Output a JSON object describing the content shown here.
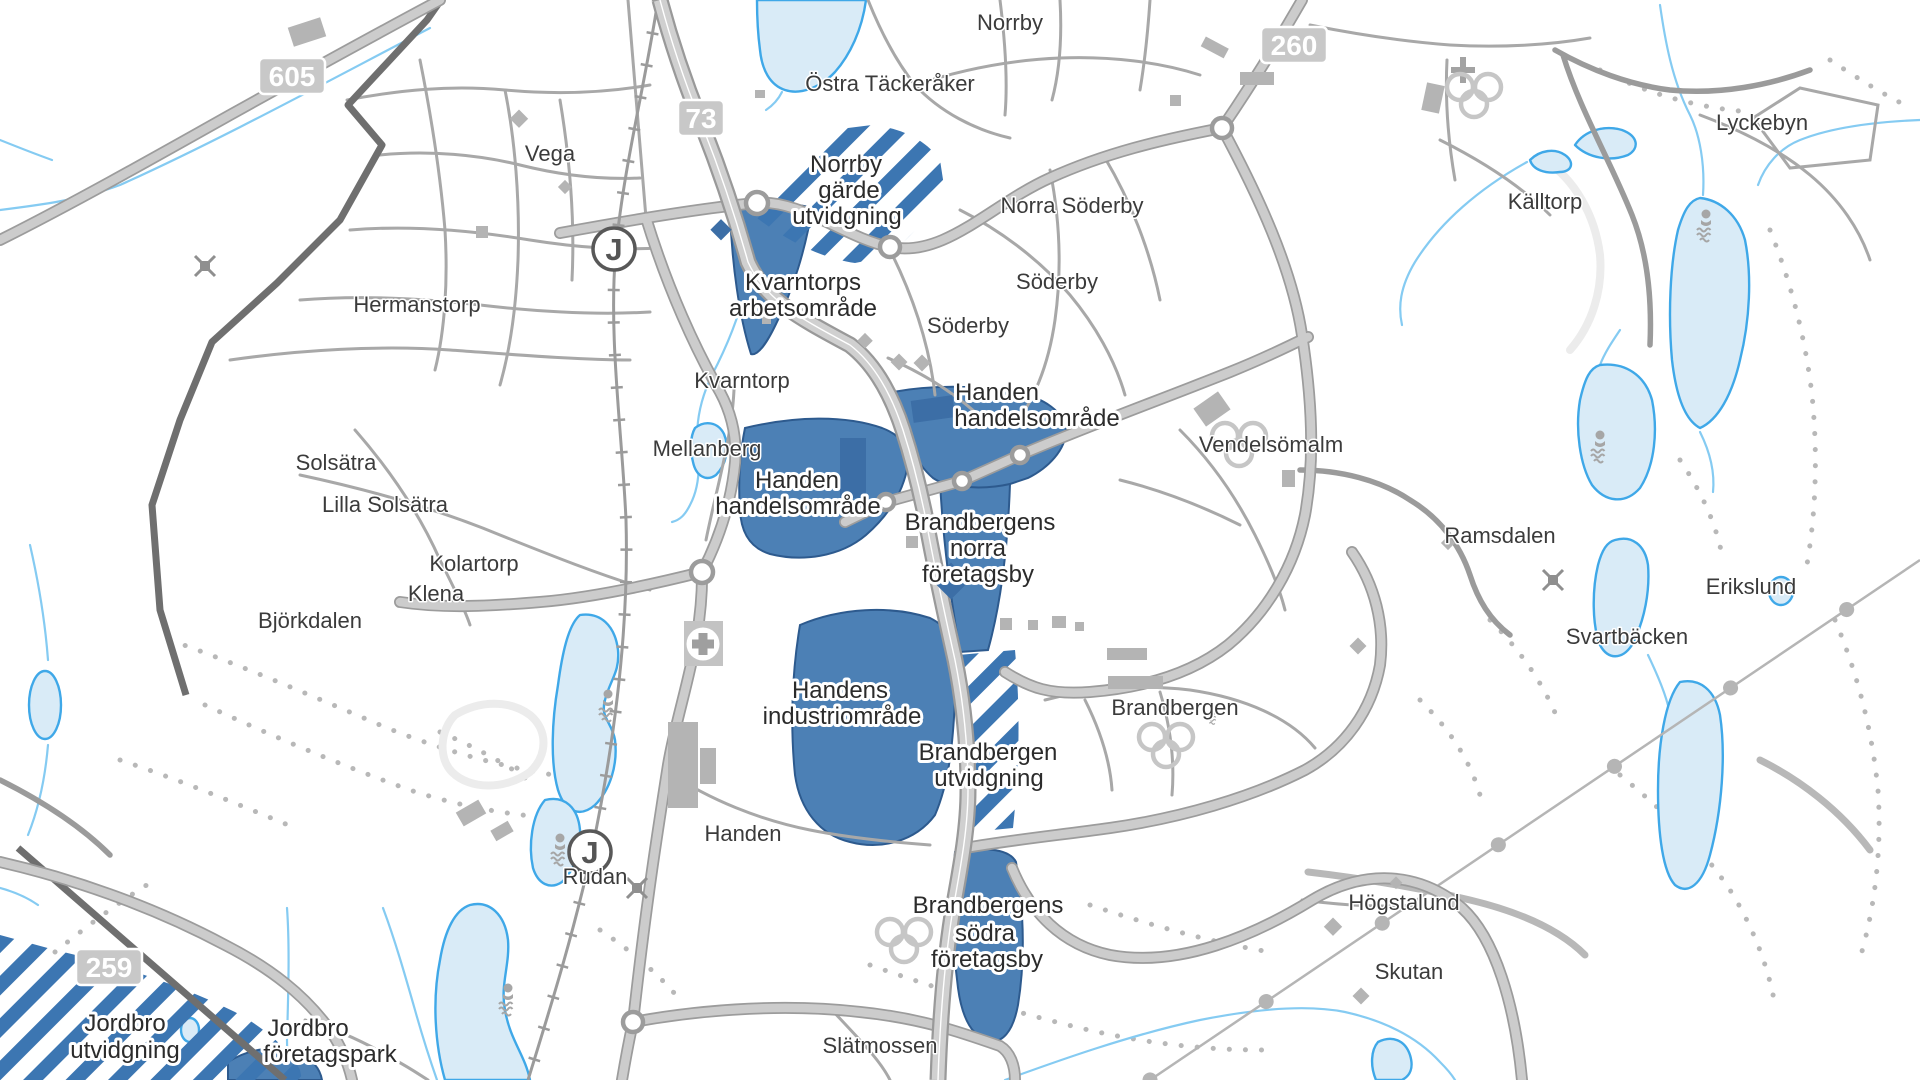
{
  "map": {
    "description": "Municipal overview map of Handen / Brandbergen / Jordbro area (Haninge) showing existing business areas (solid blue) and expansion areas (blue diagonal stripes)",
    "colors": {
      "business_area_fill": "#4c80b5",
      "business_area_border": "#2d5a8e",
      "expansion_stripe": "#3c76b2",
      "lake_fill": "#d9ebf7",
      "lake_border": "#3fa8e8",
      "stream": "#85cbf2",
      "road_fill": "#cccccc",
      "road_casing": "#9c9c9c",
      "municipal_boundary": "#6f6f6f",
      "label_text": "#3b3b3b",
      "badge_background": "#c8c8c8",
      "badge_text": "#ffffff"
    },
    "road_badges": [
      {
        "number": "605"
      },
      {
        "number": "73"
      },
      {
        "number": "260"
      },
      {
        "number": "259"
      }
    ],
    "station_symbol": "J",
    "place_labels": [
      {
        "text": "Norrby"
      },
      {
        "text": "Östra Täckeråker"
      },
      {
        "text": "Vega"
      },
      {
        "text": "Norra Söderby"
      },
      {
        "text": "Söderby"
      },
      {
        "text": "Söderby"
      },
      {
        "text": "Hermanstorp"
      },
      {
        "text": "Kvarntorp"
      },
      {
        "text": "Mellanberg"
      },
      {
        "text": "Solsätra"
      },
      {
        "text": "Lilla Solsätra"
      },
      {
        "text": "Vendelsömalm"
      },
      {
        "text": "Kolartorp"
      },
      {
        "text": "Klena"
      },
      {
        "text": "Ramsdalen"
      },
      {
        "text": "Björkdalen"
      },
      {
        "text": "Erikslund"
      },
      {
        "text": "Svartbäcken"
      },
      {
        "text": "Brandbergen"
      },
      {
        "text": "Handen"
      },
      {
        "text": "Rudan"
      },
      {
        "text": "Högstalund"
      },
      {
        "text": "Skutan"
      },
      {
        "text": "Slätmossen"
      },
      {
        "text": "Källtorp"
      },
      {
        "text": "Lyckebyn"
      }
    ],
    "area_labels": [
      {
        "name": "norrby-garde-utvidgning",
        "type": "expansion",
        "lines": [
          "Norrby",
          "gärde",
          "utvidgning"
        ]
      },
      {
        "name": "kvarntorps-arbetsomrade",
        "type": "existing",
        "lines": [
          "Kvarntorps",
          "arbetsområde"
        ]
      },
      {
        "name": "handen-handelsomrade-east",
        "type": "existing",
        "lines": [
          "Handen",
          "handelsområde"
        ]
      },
      {
        "name": "handen-handelsomrade-west",
        "type": "existing",
        "lines": [
          "Handen",
          "handelsområde"
        ]
      },
      {
        "name": "brandbergens-norra-foretagsby",
        "type": "existing",
        "lines": [
          "Brandbergens",
          "norra",
          "företagsby"
        ]
      },
      {
        "name": "handens-industriomrade",
        "type": "existing",
        "lines": [
          "Handens",
          "industriområde"
        ]
      },
      {
        "name": "brandbergen-utvidgning",
        "type": "expansion",
        "lines": [
          "Brandbergen",
          "utvidgning"
        ]
      },
      {
        "name": "brandbergens-sodra-foretagsby",
        "type": "existing",
        "lines": [
          "Brandbergens",
          "södra",
          "företagsby"
        ]
      },
      {
        "name": "jordbro-utvidgning",
        "type": "expansion",
        "lines": [
          "Jordbro",
          "utvidgning"
        ]
      },
      {
        "name": "jordbro-foretagspark",
        "type": "existing",
        "lines": [
          "Jordbro",
          "företagspark"
        ]
      }
    ],
    "icons": {
      "station": "commuter-rail-station-J",
      "hospital": "hospital-cross",
      "swimming": "swimming-area",
      "sports": "sports-rings",
      "church": "church-cross",
      "mast": "radio-mast"
    }
  }
}
